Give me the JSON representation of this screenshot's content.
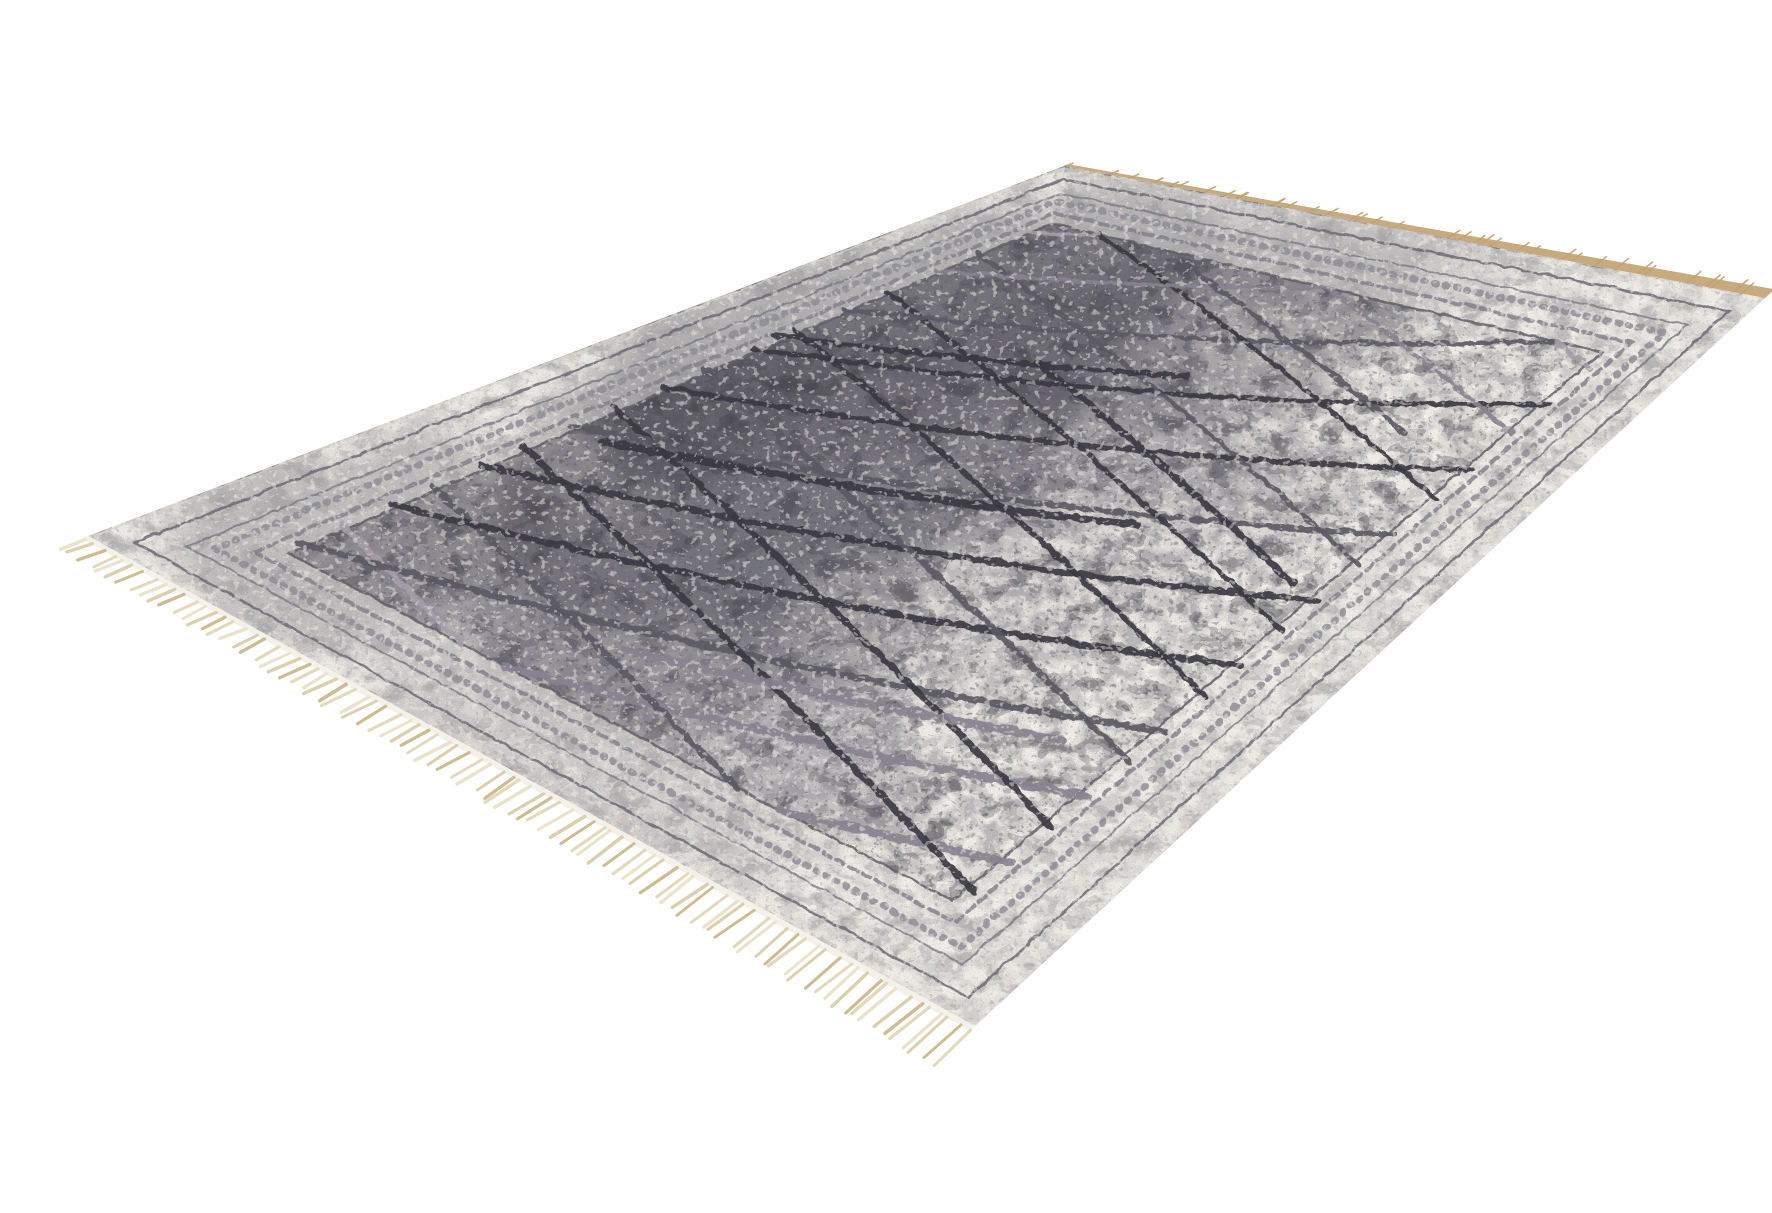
{
  "meta": {
    "type": "product-photo-cutout",
    "description": "Angled cut-out product photo of a rectangular vintage-style distressed rug in mottled grey and off-white, overlaid with a charcoal and mauve diamond trellis pattern, framed by faded ornate oriental borders, with beige fringe on the two short ends, on a plain white background.",
    "background_color": "#ffffff"
  },
  "rug": {
    "corners": {
      "top": [
        1024,
        150
      ],
      "right": [
        1725,
        282
      ],
      "bottom": [
        935,
        1010
      ],
      "left": [
        48,
        520
      ]
    },
    "base_color": "#ebe8e2",
    "patch_colors": {
      "dark": "#45444e",
      "mid": "#84838c",
      "light": "#f1eee8"
    },
    "patches": [
      {
        "u": 0.68,
        "v": 0.2,
        "ru": 0.3,
        "rv": 0.22,
        "c": "dark",
        "o": 0.7
      },
      {
        "u": 0.45,
        "v": 0.32,
        "ru": 0.26,
        "rv": 0.24,
        "c": "dark",
        "o": 0.55
      },
      {
        "u": 0.17,
        "v": 0.14,
        "ru": 0.16,
        "rv": 0.15,
        "c": "dark",
        "o": 0.5
      },
      {
        "u": 0.55,
        "v": 0.52,
        "ru": 0.32,
        "rv": 0.28,
        "c": "mid",
        "o": 0.45
      },
      {
        "u": 0.9,
        "v": 0.72,
        "ru": 0.22,
        "rv": 0.3,
        "c": "light",
        "o": 0.9
      },
      {
        "u": 0.34,
        "v": 0.72,
        "ru": 0.26,
        "rv": 0.24,
        "c": "light",
        "o": 0.65
      },
      {
        "u": 0.13,
        "v": 0.5,
        "ru": 0.16,
        "rv": 0.28,
        "c": "mid",
        "o": 0.4
      },
      {
        "u": 0.97,
        "v": 0.35,
        "ru": 0.14,
        "rv": 0.3,
        "c": "mid",
        "o": 0.45
      },
      {
        "u": 0.6,
        "v": 0.88,
        "ru": 0.34,
        "rv": 0.14,
        "c": "light",
        "o": 0.55
      },
      {
        "u": 0.27,
        "v": 0.43,
        "ru": 0.2,
        "rv": 0.18,
        "c": "dark",
        "o": 0.3
      },
      {
        "u": 0.82,
        "v": 0.45,
        "ru": 0.18,
        "rv": 0.2,
        "c": "dark",
        "o": 0.35
      },
      {
        "u": 0.05,
        "v": 0.85,
        "ru": 0.12,
        "rv": 0.14,
        "c": "light",
        "o": 0.6
      }
    ],
    "texture": {
      "blotch_dark": "#3e3d47",
      "blotch_mid": "#74737d",
      "speckle": "#4a4953",
      "erode": "#f2efe9",
      "grain": "#4e4d57"
    },
    "border": {
      "zone_fill": "#f0ede7",
      "zone_opacity": 0.5,
      "inner": {
        "u0": 0.1,
        "u1": 0.9,
        "v0": 0.118,
        "v1": 0.882
      },
      "bands": [
        {
          "u0": 0.022,
          "u1": 0.978,
          "v0": 0.028,
          "v1": 0.972,
          "color": "#6b6a74",
          "w": 2.5,
          "dash": ""
        },
        {
          "u0": 0.048,
          "u1": 0.952,
          "v0": 0.058,
          "v1": 0.942,
          "color": "#7d7c86",
          "w": 2,
          "dash": ""
        },
        {
          "u0": 0.062,
          "u1": 0.938,
          "v0": 0.074,
          "v1": 0.926,
          "color": "#8f8e98",
          "w": 7,
          "dash": "2 9"
        },
        {
          "u0": 0.082,
          "u1": 0.918,
          "v0": 0.098,
          "v1": 0.902,
          "color": "#84838d",
          "w": 4,
          "dash": "9 6"
        },
        {
          "u0": 0.1,
          "u1": 0.9,
          "v0": 0.118,
          "v1": 0.882,
          "color": "#605f69",
          "w": 2.5,
          "dash": ""
        }
      ]
    },
    "lattice": {
      "slope": 0.3,
      "start": -0.2,
      "step": 0.095,
      "count": 13,
      "field": {
        "u0": 0.1,
        "u1": 0.9,
        "v0": 0.11,
        "v1": 0.89
      },
      "palette": [
        "#3b3a43",
        "#5b5a64",
        "#8a8391",
        "#a79fab",
        "#6e6d77"
      ],
      "family_a_colors": [
        3,
        2,
        2,
        1,
        0,
        0,
        1,
        0,
        0,
        1,
        2,
        3,
        2
      ],
      "family_b_colors": [
        2,
        3,
        1,
        0,
        0,
        1,
        0,
        0,
        1,
        0,
        2,
        3,
        1
      ],
      "extra_segments": [
        {
          "from": [
            0.4,
            0.15
          ],
          "to": [
            0.55,
            0.65
          ],
          "color": 0,
          "wf": 1.35
        },
        {
          "from": [
            0.55,
            0.85
          ],
          "to": [
            0.7,
            0.35
          ],
          "color": 0,
          "wf": 1.35
        },
        {
          "from": [
            0.75,
            0.78
          ],
          "to": [
            0.88,
            0.34
          ],
          "color": 1,
          "wf": 1.2
        },
        {
          "from": [
            0.18,
            0.42
          ],
          "to": [
            0.3,
            0.82
          ],
          "color": 2,
          "wf": 1.2
        },
        {
          "from": [
            0.62,
            0.1
          ],
          "to": [
            0.74,
            0.5
          ],
          "color": 0,
          "wf": 1.25
        }
      ]
    },
    "fringe": {
      "near": {
        "count": 88,
        "len0": 25,
        "len1": 50,
        "width": 2.8,
        "colors": [
          "#eae1c9",
          "#dbcda9",
          "#cbb88c",
          "#e2d6b8"
        ],
        "selvage_color": "#f4f1ea",
        "selvage_w": 7
      },
      "far": {
        "w0": 5,
        "w1": 13,
        "color": "#c7aa7d",
        "tassels": 40,
        "tassel_color": "#c2a272"
      }
    },
    "edges": {
      "back_line": "#d8d4ca",
      "front_line": "#cfcabf"
    }
  }
}
